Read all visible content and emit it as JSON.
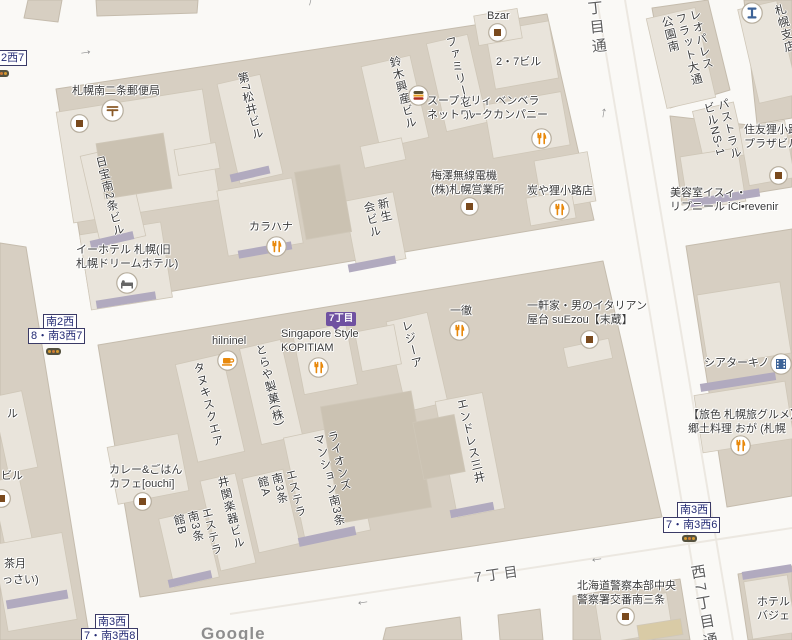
{
  "palette": {
    "road": "#faf9f6",
    "block": "#d7cfc2",
    "building": "#e9e4db",
    "building_dark": "#cbc2b2",
    "awning": "#b1aabf",
    "badge_purple": "#6f51a1",
    "badge_text": "#232a74",
    "restaurant_orange": "#e8890c",
    "poi_brown": "#7a4a1e",
    "blue_icon": "#3d6398"
  },
  "streets": [
    {
      "text": "西7丁目通",
      "mode": "v",
      "x": 580,
      "y": -30,
      "rot": -6,
      "size": 15
    },
    {
      "text": "西7丁目通",
      "mode": "v",
      "x": 686,
      "y": 566,
      "rot": -10,
      "size": 15
    },
    {
      "text": "7丁目",
      "mode": "h",
      "x": 474,
      "y": 564,
      "rot": -8,
      "size": 14
    }
  ],
  "badges": [
    {
      "text": "2西7",
      "x": -2,
      "y": 50
    },
    {
      "text": "南2西",
      "x": 43,
      "y": 314
    },
    {
      "text": "8・南3西7",
      "x": 28,
      "y": 328
    },
    {
      "text": "南3西",
      "x": 95,
      "y": 614
    },
    {
      "text": "7・南3西8",
      "x": 81,
      "y": 628
    },
    {
      "text": "南3西",
      "x": 677,
      "y": 502
    },
    {
      "text": "7・南3西6",
      "x": 663,
      "y": 517
    }
  ],
  "arcade_badge": {
    "text": "7丁目",
    "x": 326,
    "y": 312
  },
  "pois": [
    {
      "lines": [
        "札幌南二条郵便局"
      ],
      "x": 72,
      "y": 85
    },
    {
      "lines": [
        "Bzar"
      ],
      "x": 487,
      "y": 10
    },
    {
      "lines": [
        "2・7ビル"
      ],
      "x": 496,
      "y": 56
    },
    {
      "lines": [
        "スープカリィ ベンベラ",
        "ネットワークカンパニー"
      ],
      "x": 427,
      "y": 95
    },
    {
      "lines": [
        "梅澤無線電機",
        "(株)札幌営業所"
      ],
      "x": 431,
      "y": 170
    },
    {
      "lines": [
        "炭や狸小路店"
      ],
      "x": 527,
      "y": 185
    },
    {
      "lines": [
        "美容室イスィ・",
        "リプニール iCi•revenir"
      ],
      "x": 670,
      "y": 187
    },
    {
      "lines": [
        "カラハナ"
      ],
      "x": 249,
      "y": 221
    },
    {
      "lines": [
        "イーホテル 札幌(旧",
        "札幌ドリームホテル)"
      ],
      "x": 76,
      "y": 244
    },
    {
      "lines": [
        "hilninel"
      ],
      "x": 212,
      "y": 335
    },
    {
      "lines": [
        "Singapore Style",
        "KOPITIAM"
      ],
      "x": 281,
      "y": 328
    },
    {
      "lines": [
        "一徹"
      ],
      "x": 450,
      "y": 305
    },
    {
      "lines": [
        "一軒家・男のイタリアン",
        "屋台 suEzou【末蔵】"
      ],
      "x": 527,
      "y": 300
    },
    {
      "lines": [
        "シアターキノ"
      ],
      "x": 704,
      "y": 357
    },
    {
      "lines": [
        "【旅色 札幌旅グルメ】",
        "郷土料理 おが (札幌"
      ],
      "x": 688,
      "y": 409
    },
    {
      "lines": [
        "カレー&ごはん",
        "カフェ[ouchi]"
      ],
      "x": 109,
      "y": 464
    },
    {
      "lines": [
        "北海道警察本部中央",
        "警察署交番南三条"
      ],
      "x": 577,
      "y": 580
    },
    {
      "lines": [
        "ホテル",
        "バジェ"
      ],
      "x": 757,
      "y": 596
    },
    {
      "lines": [
        "住友狸小路",
        "プラザビル"
      ],
      "x": 744,
      "y": 124
    },
    {
      "lines": [
        "茶月"
      ],
      "x": 4,
      "y": 558
    },
    {
      "lines": [
        "っさい)"
      ],
      "x": 2,
      "y": 574
    },
    {
      "lines": [
        "ビル"
      ],
      "x": 1,
      "y": 470
    },
    {
      "lines": [
        "ル"
      ],
      "x": 7,
      "y": 408
    }
  ],
  "vlabels": [
    {
      "text": "第7松井ビル",
      "x": 234,
      "y": 74,
      "rot": -14
    },
    {
      "text": "鈴木興産ビル",
      "x": 386,
      "y": 58,
      "rot": -14
    },
    {
      "text": "ファミリービル",
      "x": 442,
      "y": 38,
      "rot": -14
    },
    {
      "text": "レオパレス\nフラット大通\n公園南",
      "x": 658,
      "y": 18,
      "rot": -14
    },
    {
      "text": "パストラル\nビルNS-1",
      "x": 700,
      "y": 104,
      "rot": -14
    },
    {
      "text": "日宝南2条ビル",
      "x": 92,
      "y": 158,
      "rot": -14
    },
    {
      "text": "新生\n会ビル",
      "x": 360,
      "y": 203,
      "rot": -13
    },
    {
      "text": "タヌキスクエア",
      "x": 190,
      "y": 364,
      "rot": -14
    },
    {
      "text": "とらや製菓(株)",
      "x": 252,
      "y": 346,
      "rot": -14
    },
    {
      "text": "レジーア",
      "x": 398,
      "y": 322,
      "rot": -14
    },
    {
      "text": "エンドレス三井",
      "x": 453,
      "y": 400,
      "rot": -13
    },
    {
      "text": "ライオンズ\nマンション南3条",
      "x": 310,
      "y": 436,
      "rot": -14
    },
    {
      "text": "井関楽器ビル",
      "x": 214,
      "y": 478,
      "rot": -14
    },
    {
      "text": "エステラ\n南3条\n館B",
      "x": 170,
      "y": 516,
      "rot": -14
    },
    {
      "text": "エステラ\n南3条\n館A",
      "x": 254,
      "y": 478,
      "rot": -14
    },
    {
      "text": "札幌支店",
      "x": 771,
      "y": 6,
      "rot": -14
    }
  ],
  "icons": [
    {
      "type": "post",
      "x": 101,
      "y": 99
    },
    {
      "type": "generic",
      "x": 70,
      "y": 114
    },
    {
      "type": "generic",
      "x": 488,
      "y": 23
    },
    {
      "type": "fastfood",
      "x": 408,
      "y": 85
    },
    {
      "type": "restaurant",
      "x": 531,
      "y": 128
    },
    {
      "type": "generic",
      "x": 460,
      "y": 197
    },
    {
      "type": "restaurant",
      "x": 549,
      "y": 199
    },
    {
      "type": "restaurant",
      "x": 266,
      "y": 236
    },
    {
      "type": "hotel",
      "x": 116,
      "y": 272
    },
    {
      "type": "clothing",
      "x": 741,
      "y": 2
    },
    {
      "type": "generic",
      "x": 769,
      "y": 166
    },
    {
      "type": "cafe",
      "x": 217,
      "y": 350
    },
    {
      "type": "restaurant",
      "x": 308,
      "y": 357
    },
    {
      "type": "restaurant",
      "x": 449,
      "y": 320
    },
    {
      "type": "generic",
      "x": 580,
      "y": 330
    },
    {
      "type": "cinema",
      "x": 770,
      "y": 353
    },
    {
      "type": "restaurant",
      "x": 730,
      "y": 435
    },
    {
      "type": "generic",
      "x": 133,
      "y": 492
    },
    {
      "type": "generic",
      "x": 616,
      "y": 607
    },
    {
      "type": "generic",
      "x": -8,
      "y": 489
    }
  ],
  "traffic_lights": [
    {
      "x": -6,
      "y": 70
    },
    {
      "x": 46,
      "y": 348
    },
    {
      "x": 682,
      "y": 535
    }
  ],
  "arrows": [
    {
      "glyph": "→",
      "x": 78,
      "y": 42,
      "rot": -9
    },
    {
      "glyph": "↑",
      "x": 600,
      "y": 104,
      "rot": 10
    },
    {
      "glyph": "←",
      "x": 355,
      "y": 592,
      "rot": -9
    },
    {
      "glyph": "←",
      "x": 589,
      "y": 549,
      "rot": -9
    },
    {
      "glyph": "↑",
      "x": 307,
      "y": -8,
      "rot": 14
    }
  ],
  "google": {
    "text": "Google",
    "x": 201,
    "y": 624
  }
}
